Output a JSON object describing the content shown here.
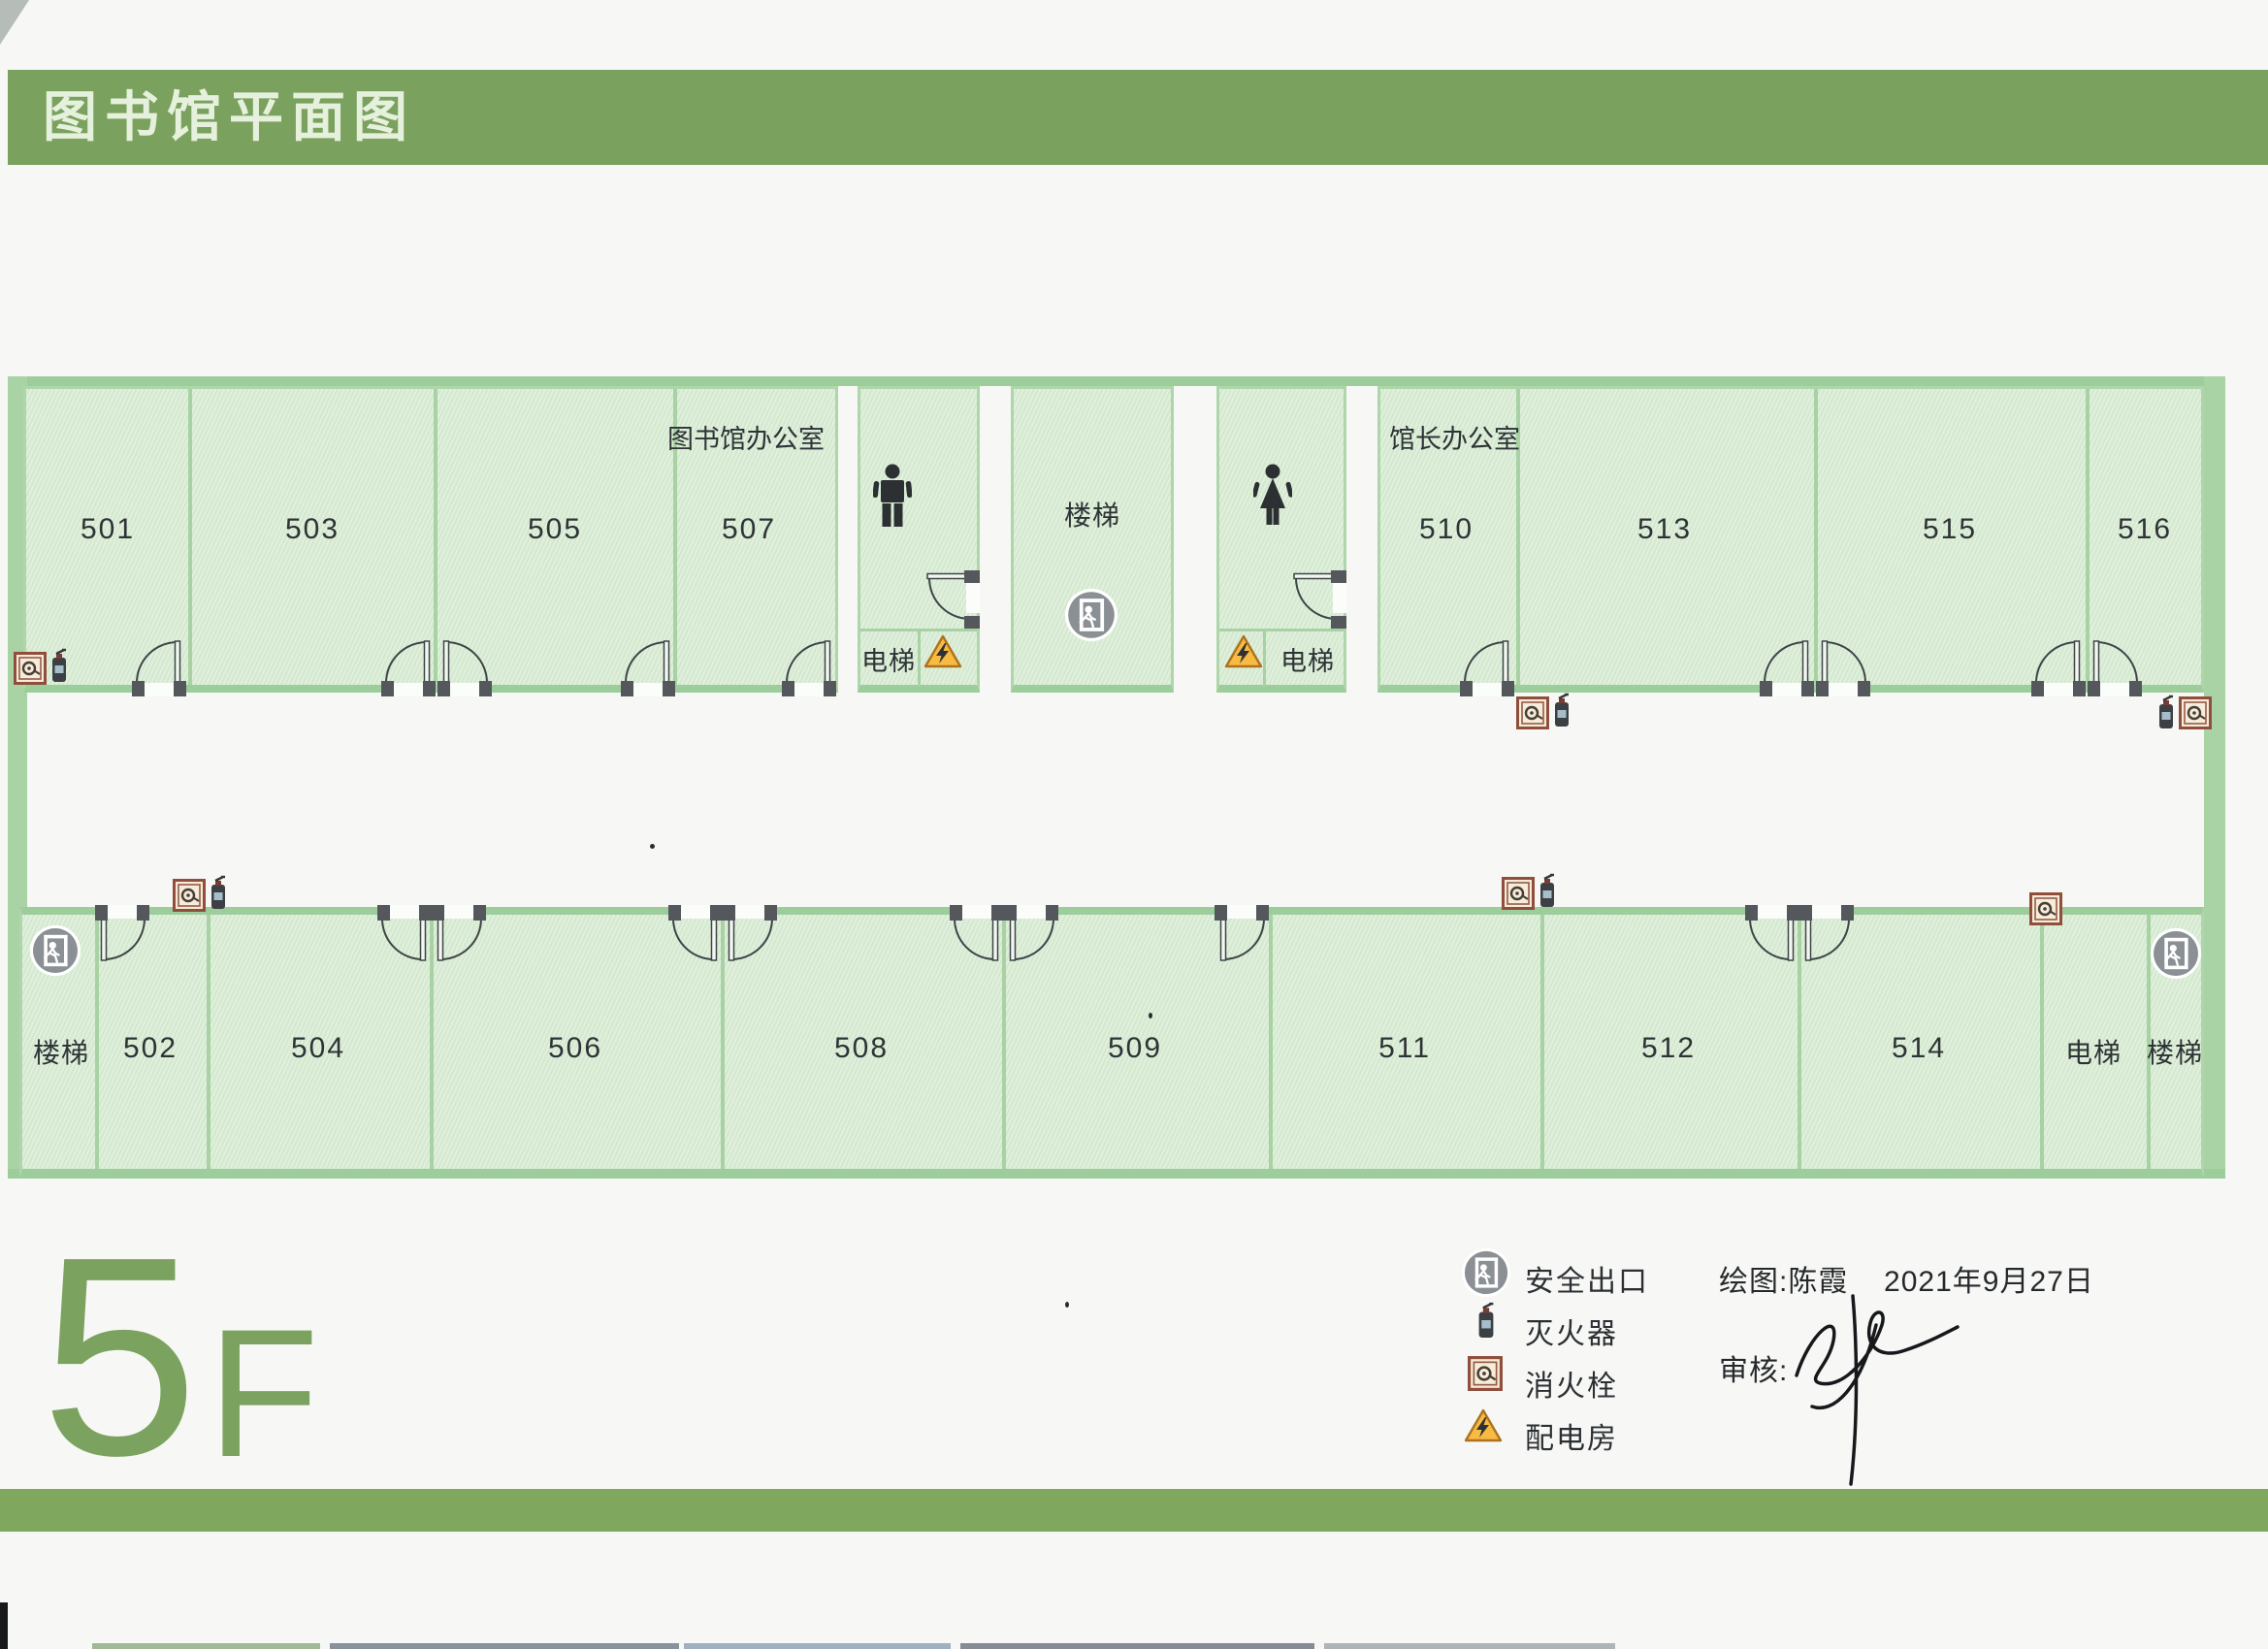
{
  "title": "图书馆平面图",
  "floor_label": {
    "number": "5",
    "letter": "F"
  },
  "colors": {
    "banner_green": "#7aa15d",
    "bottom_bar_green": "#7fa75e",
    "wall_green": "#9ecd9c",
    "room_fill_green": "#d9ecd6",
    "floor_text_green": "#7ba35f",
    "exit_badge_gray": "#8b9095",
    "warning_yellow": "#f7ba43",
    "hydrant_brown": "#8f4f3c"
  },
  "plan": {
    "top_row": {
      "rooms": [
        {
          "label": "501"
        },
        {
          "label": "503"
        },
        {
          "label": "505"
        },
        {
          "label": "507"
        },
        {
          "label": "楼梯"
        },
        {
          "label": "510"
        },
        {
          "label": "513"
        },
        {
          "label": "515"
        },
        {
          "label": "516"
        }
      ],
      "annotations": {
        "library_office": "图书馆办公室",
        "director_office": "馆长办公室"
      },
      "elevators": [
        {
          "label": "电梯"
        },
        {
          "label": "电梯"
        }
      ]
    },
    "bottom_row": {
      "rooms": [
        {
          "label": "楼梯"
        },
        {
          "label": "502"
        },
        {
          "label": "504"
        },
        {
          "label": "506"
        },
        {
          "label": "508"
        },
        {
          "label": "509"
        },
        {
          "label": "511"
        },
        {
          "label": "512"
        },
        {
          "label": "514"
        },
        {
          "label": "电梯"
        },
        {
          "label": "楼梯"
        }
      ]
    }
  },
  "legend": {
    "items": [
      {
        "icon": "exit-icon",
        "label": "安全出口"
      },
      {
        "icon": "fire-extinguisher-icon",
        "label": "灭火器"
      },
      {
        "icon": "fire-hydrant-icon",
        "label": "消火栓"
      },
      {
        "icon": "power-room-icon",
        "label": "配电房"
      }
    ]
  },
  "credits": {
    "drawn_by": "绘图:陈霞",
    "date": "2021年9月27日",
    "review": "审核:"
  }
}
